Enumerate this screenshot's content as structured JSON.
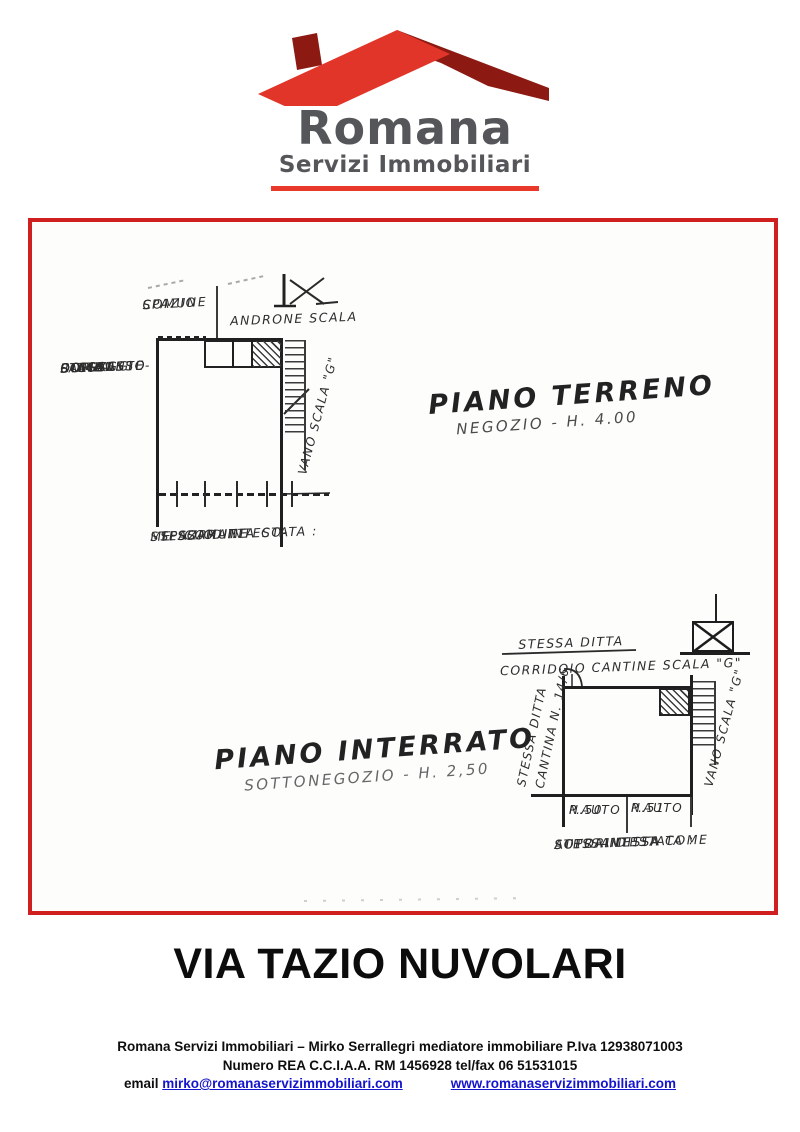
{
  "logo": {
    "brand": "Romana",
    "subtitle": "Servizi Immobiliari",
    "colors": {
      "roof_red": "#e2352a",
      "roof_dark": "#8c1a12",
      "text_gray": "#54565a",
      "bar_red": "#e8392b"
    }
  },
  "frame_color": "#d01f1f",
  "plan": {
    "ground": {
      "title": "PIANO TERRENO",
      "subtitle": "NEGOZIO - H. 4.00",
      "spazio_comune": [
        "SPAZIO",
        "COMUNE"
      ],
      "androne": "ANDRONE SCALA",
      "left_note": [
        "STESSA",
        "DITTA",
        "COME",
        "SOPRAINTE-",
        "STATA :",
        "PASSAGGIO",
        "COMUNE",
        "D'ACCESSO"
      ],
      "vano_scala": "VANO SCALA \"G\"",
      "bottom_note": [
        "STESSA DITTA CO-",
        "ME SOPRAINTESTATA :",
        "SPAZIO",
        "COMUNE"
      ]
    },
    "basement": {
      "title": "PIANO INTERRATO",
      "subtitle": "SOTTONEGOZIO - H. 2,50",
      "header": "STESSA DITTA",
      "corridoio": "CORRIDOIO CANTINE SCALA \"G\"",
      "wall_note_1": "STESSA DITTA",
      "wall_note_2": "CANTINA N. 14/6",
      "vano_scala": "VANO SCALA \"G\"",
      "parking": [
        {
          "line1": "P.AUTO",
          "line2": "N.50"
        },
        {
          "line1": "P.AUTO",
          "line2": "N.51"
        }
      ],
      "bottom_note": [
        "STESSA DITTA COME",
        "SOPRAINTESTATA :",
        "AUTORIMESSA"
      ]
    }
  },
  "street_title": "VIA TAZIO NUVOLARI",
  "footer": {
    "line1": "Romana Servizi Immobiliari – Mirko Serrallegri mediatore immobiliare P.Iva 12938071003",
    "line2": "Numero REA C.C.I.A.A. RM 1456928 tel/fax 06 51531015",
    "email_label": "email",
    "email_link": "mirko@romanaservizimmobiliari.com",
    "website_link": "www.romanaservizimmobiliari.com"
  }
}
